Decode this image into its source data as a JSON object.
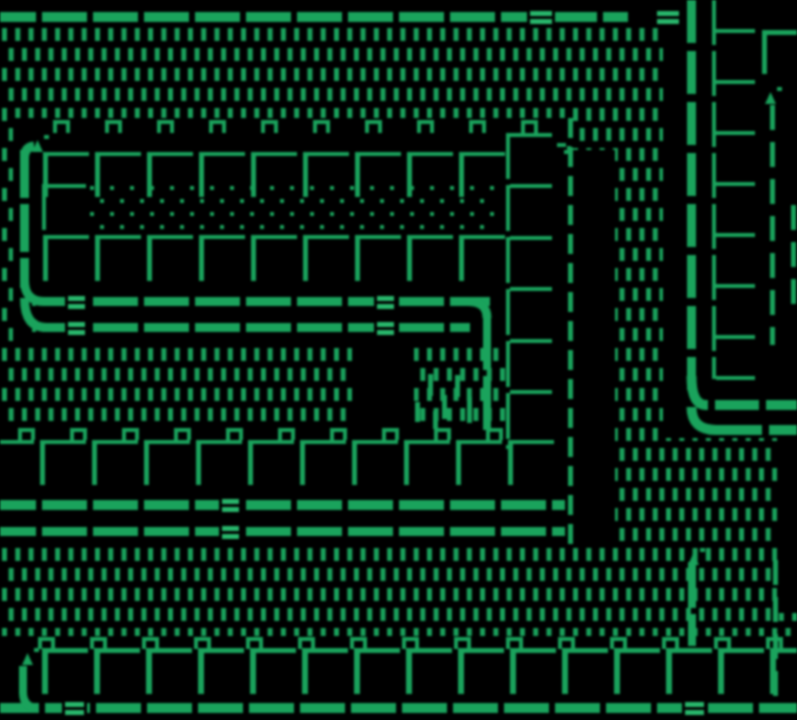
{
  "meta": {
    "title": "Monochrome green tile-map game screen",
    "type": "game-screen"
  },
  "scene": {
    "width": 797,
    "height": 720,
    "palette": {
      "bg": "#000000",
      "fg": "#1e9e5c",
      "fg_bright": "#2db36c"
    },
    "dash_field": {
      "x0": 2,
      "y0": 28,
      "pitch_x": 13.28,
      "pitch_y": 20,
      "stagger": 6.64,
      "dash_w": 5,
      "dash_h": 13,
      "rows": 31,
      "cols": 61
    },
    "black_rects": [
      [
        0,
        0,
        797,
        28
      ],
      [
        13,
        118,
        495,
        227
      ],
      [
        505,
        118,
        68,
        428
      ],
      [
        573,
        150,
        42,
        396
      ],
      [
        0,
        425,
        573,
        121
      ],
      [
        663,
        0,
        134,
        438
      ],
      [
        777,
        438,
        20,
        175
      ],
      [
        0,
        636,
        797,
        84
      ],
      [
        352,
        338,
        62,
        92
      ]
    ],
    "dot_floor": {
      "x0": 90,
      "y0": 186,
      "x_max": 497,
      "rows": 4,
      "pitch_x": 20,
      "pitch_y": 13,
      "stagger": 10,
      "size": 4
    },
    "tall_dashes": [
      [
        428,
        374,
        5,
        22
      ],
      [
        442,
        395,
        5,
        24
      ],
      [
        455,
        375,
        5,
        22
      ],
      [
        467,
        397,
        5,
        26
      ],
      [
        415,
        402,
        5,
        20
      ],
      [
        433,
        411,
        5,
        18
      ]
    ],
    "rails": [
      {
        "name": "top-rail",
        "y": 12,
        "t": 10,
        "x0": 0,
        "x1": 628,
        "gap_phase": 36,
        "pitch": 51,
        "gap_w": 6,
        "doubles": [
          530,
          657
        ],
        "double_w": 22
      },
      {
        "name": "mid-rail-upper",
        "y": 297,
        "t": 9,
        "x0": 32,
        "x1": 490,
        "gap_phase": 36,
        "pitch": 51,
        "gap_w": 6,
        "doubles": [
          68,
          377
        ],
        "double_w": 17
      },
      {
        "name": "mid-rail-lower",
        "y": 323,
        "t": 9,
        "x0": 32,
        "x1": 470,
        "gap_phase": 36,
        "pitch": 51,
        "gap_w": 6,
        "doubles": [
          68,
          377
        ],
        "double_w": 17
      },
      {
        "name": "low-rail-upper",
        "y": 500,
        "t": 10,
        "x0": 0,
        "x1": 565,
        "gap_phase": 36,
        "pitch": 51,
        "gap_w": 6,
        "doubles": [
          222
        ],
        "double_w": 17
      },
      {
        "name": "low-rail-lower",
        "y": 527,
        "t": 9,
        "x0": 0,
        "x1": 565,
        "gap_phase": 36,
        "pitch": 51,
        "gap_w": 6,
        "doubles": [
          222
        ],
        "double_w": 17
      },
      {
        "name": "bottom-rail",
        "y": 703,
        "t": 10,
        "x0": 0,
        "x1": 797,
        "gap_phase": 39,
        "pitch": 51,
        "gap_w": 6,
        "doubles": [
          65,
          685
        ],
        "double_w": 19
      },
      {
        "name": "elbow-rail-upper",
        "y": 400,
        "t": 10,
        "x0": 704,
        "x1": 797,
        "gap_phase": 45,
        "pitch": 51,
        "gap_w": 7,
        "doubles": [],
        "double_w": 0
      },
      {
        "name": "elbow-rail-lower",
        "y": 425,
        "t": 10,
        "x0": 714,
        "x1": 797,
        "gap_phase": 48,
        "pitch": 51,
        "gap_w": 7,
        "doubles": [],
        "double_w": 0
      }
    ],
    "v_rails": [
      {
        "name": "left-pipe",
        "x": 20,
        "w": 9,
        "y0": 150,
        "y1": 288,
        "dash": 48,
        "gap": 6
      },
      {
        "name": "mid-rail-drop",
        "x": 483,
        "w": 8,
        "y0": 316,
        "y1": 434,
        "dash": 54,
        "gap": 6
      },
      {
        "name": "right-pipe",
        "x": 687,
        "w": 9,
        "y0": 0,
        "y1": 390,
        "dash": 43,
        "gap": 8
      },
      {
        "name": "bottom-right-post",
        "x": 688,
        "w": 8,
        "y0": 562,
        "y1": 646,
        "dash": 46,
        "gap": 6
      },
      {
        "name": "bottom-left-post",
        "x": 19,
        "w": 8,
        "y0": 666,
        "y1": 694,
        "dash": 40,
        "gap": 5
      }
    ],
    "dashed_lines": [
      {
        "name": "corridor-boundary",
        "x": 568,
        "w": 5,
        "y0": 118,
        "y1": 548,
        "dash": 20,
        "gap": 9
      },
      {
        "name": "right-boundary-upper",
        "x": 770,
        "w": 5,
        "y0": 105,
        "y1": 345,
        "dash": 25,
        "gap": 12
      },
      {
        "name": "right-boundary-edge",
        "x": 791,
        "w": 5,
        "y0": 205,
        "y1": 310,
        "dash": 25,
        "gap": 12
      },
      {
        "name": "right-boundary-lower",
        "x": 773,
        "w": 5,
        "y0": 560,
        "y1": 710,
        "dash": 25,
        "gap": 12
      }
    ],
    "bracket_columns": [
      {
        "name": "inner-right-column",
        "x": 712,
        "w": 4,
        "y0": 0,
        "y1": 379,
        "ticks": [
          29,
          80,
          131,
          182,
          233,
          284,
          335,
          376
        ],
        "tick_len": 39,
        "tick_t": 4,
        "seg": 45,
        "seg_gap": 6
      },
      {
        "name": "mid-right-column",
        "x": 506,
        "w": 4,
        "y0": 133,
        "y1": 449,
        "ticks": [
          133,
          184,
          236,
          287,
          339,
          390
        ],
        "tick_len": 42,
        "tick_t": 4,
        "seg": 46,
        "seg_gap": 6
      }
    ],
    "arcs": [
      {
        "pts": [
          [
            24.5,
            280
          ],
          [
            24.5,
            301.5
          ],
          [
            44,
            301.5
          ]
        ],
        "lw": 9
      },
      {
        "pts": [
          [
            24.5,
            298
          ],
          [
            24.5,
            327.5
          ],
          [
            46,
            327.5
          ]
        ],
        "lw": 9
      },
      {
        "pts": [
          [
            24.5,
            158
          ],
          [
            24.5,
            147
          ],
          [
            34,
            146
          ]
        ],
        "lw": 9
      },
      {
        "pts": [
          [
            468,
            301.5
          ],
          [
            487,
            301.5
          ],
          [
            487,
            318
          ]
        ],
        "lw": 9
      },
      {
        "pts": [
          [
            691.5,
            376
          ],
          [
            691.5,
            405
          ],
          [
            706,
            405
          ]
        ],
        "lw": 10
      },
      {
        "pts": [
          [
            691.5,
            407
          ],
          [
            691.5,
            430
          ],
          [
            716,
            430
          ]
        ],
        "lw": 10
      },
      {
        "pts": [
          [
            23,
            692
          ],
          [
            23,
            708
          ],
          [
            38,
            708
          ]
        ],
        "lw": 8
      }
    ],
    "brick_rows": [
      {
        "name": "wall-row-top",
        "cap_x0": 53,
        "cap_step": 52,
        "cap_n": 10,
        "cap_y": 120,
        "cap_h": 13,
        "brick_x0": 43,
        "brick_step": 52,
        "brick_n": 9,
        "line_y": 152,
        "h_len": 46,
        "v_len": 45,
        "t": 4
      },
      {
        "name": "wall-row-second",
        "cap_n": 0,
        "cap_step": 52,
        "cap_x0": 0,
        "cap_y": 0,
        "cap_h": 0,
        "brick_x0": 43,
        "brick_step": 52,
        "brick_n": 9,
        "line_y": 235,
        "h_len": 46,
        "v_len": 46,
        "t": 4
      },
      {
        "name": "wall-row-third",
        "cap_x0": 18,
        "cap_step": 52,
        "cap_n": 10,
        "cap_y": 428,
        "cap_h": 12,
        "brick_x0": -12,
        "brick_step": 52,
        "brick_n": 11,
        "line_y": 440,
        "h_len": 46,
        "v_len": 45,
        "t": 4
      },
      {
        "name": "wall-row-bottom",
        "cap_x0": 38,
        "cap_step": 52,
        "cap_n": 15,
        "cap_y": 637,
        "cap_h": 12,
        "brick_x0": 42,
        "brick_step": 52,
        "brick_n": 15,
        "line_y": 648,
        "h_len": 46,
        "v_len": 46,
        "t": 5
      }
    ],
    "extras": {
      "corner_top_right": {
        "v": [
          762,
          30,
          5,
          44
        ],
        "h": [
          762,
          30,
          35,
          5
        ]
      },
      "dot_floor_cap": {
        "h": [
          42,
          184,
          44,
          4
        ],
        "v": [
          42,
          184,
          4,
          46
        ]
      },
      "curl_sprite": {
        "rects": [
          [
            557,
            143,
            9,
            4
          ],
          [
            564,
            150,
            8,
            4
          ],
          [
            567,
            146,
            4,
            4
          ]
        ]
      }
    },
    "sprites": [
      {
        "name": "sprite-top-left",
        "x": 32,
        "y": 140
      },
      {
        "name": "sprite-top-right",
        "x": 765,
        "y": 92
      },
      {
        "name": "sprite-bottom-right",
        "x": 688,
        "y": 553
      },
      {
        "name": "sprite-bottom-left",
        "x": 22,
        "y": 653
      }
    ]
  }
}
